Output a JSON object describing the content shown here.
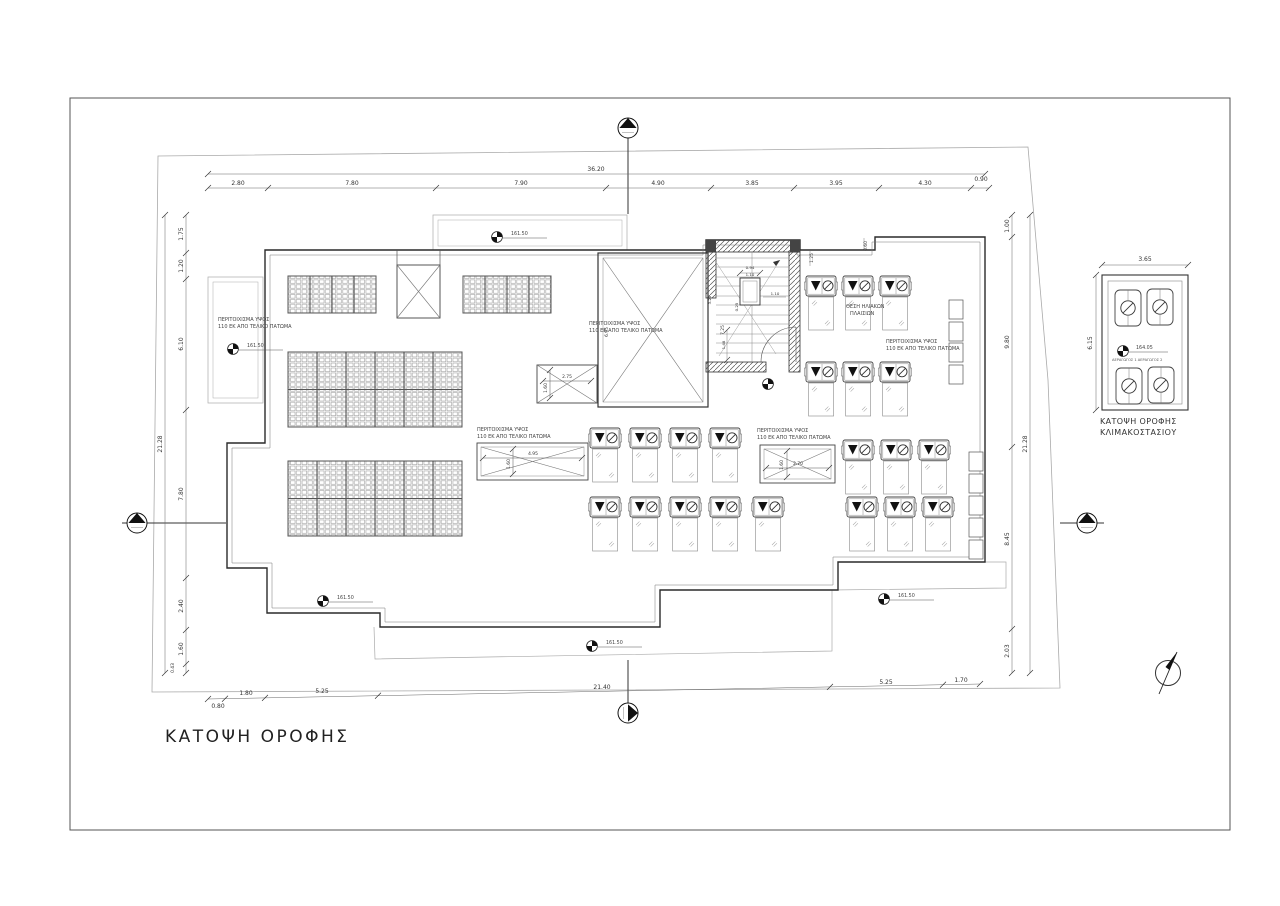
{
  "title": "ΚΑΤΟΨΗ ΟΡΟΦΗΣ",
  "elevation_main": "161.50",
  "labels": {
    "parapet_line1": "ΠΕΡΙΤΟΙΧΙΣΜΑ ΥΨΟΣ",
    "parapet_line2": "110 ΕΚ ΑΠΟ ΤΕΛΙΚΟ ΠΑΤΩΜΑ",
    "solar_line1": "ΘΕΣΗ ΗΛΙΑΚΩΝ",
    "solar_line2": "ΠΛΑΙΣΙΩΝ"
  },
  "detail": {
    "caption_line1": "ΚΑΤΟΨΗ ΟΡΟΦΗΣ",
    "caption_line2": "ΚΛΙΜΑΚΟΣΤΑΣΙΟΥ",
    "width": "3.65",
    "height": "6.15",
    "elevation": "164.05",
    "vent_label": "ΑΕΡΑΓΩΓΟΣ 1  ΑΕΡΑΓΩΓΟΣ 2"
  },
  "dims": {
    "top_total": "36.20",
    "top": [
      "2.80",
      "7.80",
      "7.90",
      "4.90",
      "3.85",
      "3.95",
      "4.30",
      "0.90"
    ],
    "left_total": "21.28",
    "left": [
      "1.75",
      "1.20",
      "6.10",
      "7.80",
      "2.40",
      "1.60",
      "0.43"
    ],
    "right_total": "21.28",
    "right": [
      "1.00",
      "9.80",
      "8.45",
      "2.03"
    ],
    "bottom": [
      "0.80",
      "1.80",
      "5.25",
      "21.40",
      "5.25",
      "1.70"
    ],
    "shaft_left": "6.95",
    "shaft_right": "7.25",
    "box1_w": "2.75",
    "box2_w": "4.95",
    "box3_w": "2.70",
    "box_h": "1.60",
    "stair": {
      "a": "0.94",
      "b": "1.10",
      "c": "1.10",
      "d": "1.48",
      "e": "3.25",
      "f": "0.25",
      "g": "1.25",
      "h": "0.60"
    }
  }
}
